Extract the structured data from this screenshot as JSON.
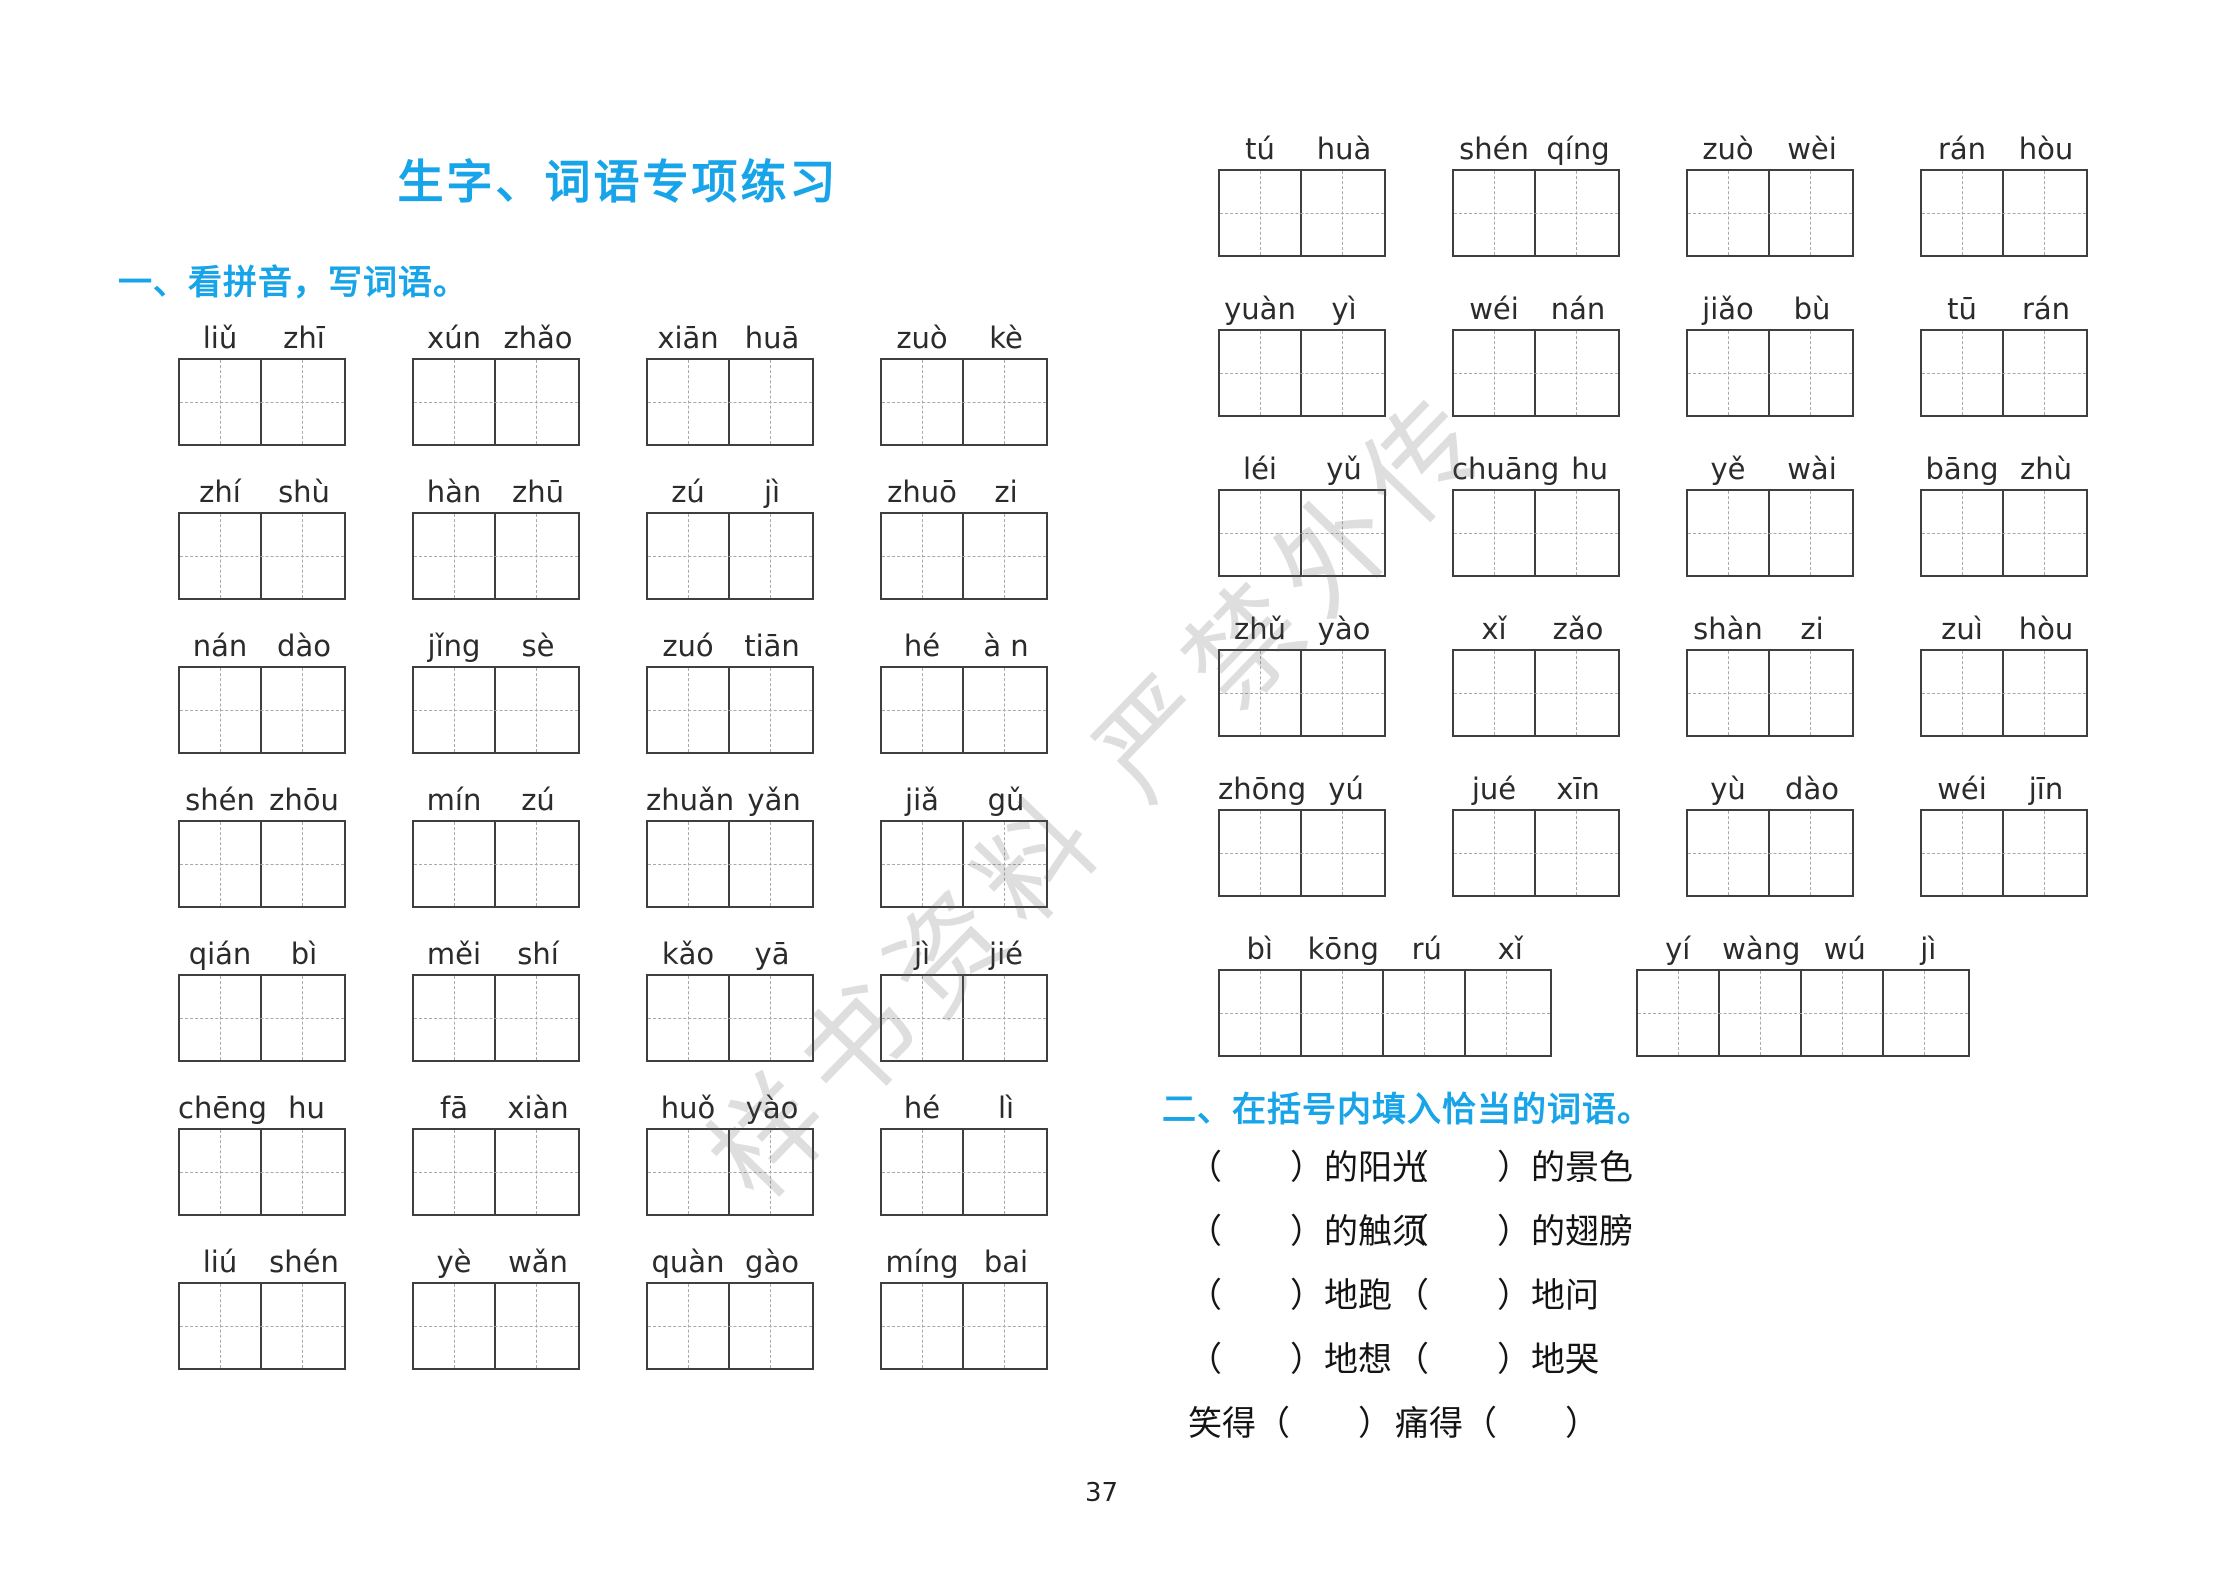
{
  "page": {
    "title": "生字、词语专项练习",
    "page_number": "37",
    "accent_color": "#18a4e8",
    "watermark": "样书资料 严禁外传"
  },
  "section_one": {
    "heading": "一、看拼音，写词语。",
    "left_groups": [
      {
        "syllables": [
          "liǔ",
          "zhī"
        ]
      },
      {
        "syllables": [
          "xún",
          "zhǎo"
        ]
      },
      {
        "syllables": [
          "xiān",
          "huā"
        ]
      },
      {
        "syllables": [
          "zuò",
          "kè"
        ]
      },
      {
        "syllables": [
          "zhí",
          "shù"
        ]
      },
      {
        "syllables": [
          "hàn",
          "zhū"
        ]
      },
      {
        "syllables": [
          "zú",
          "jì"
        ]
      },
      {
        "syllables": [
          "zhuō",
          "zi"
        ]
      },
      {
        "syllables": [
          "nán",
          "dào"
        ]
      },
      {
        "syllables": [
          "jǐng",
          "sè"
        ]
      },
      {
        "syllables": [
          "zuó",
          "tiān"
        ]
      },
      {
        "syllables": [
          "hé",
          "à n"
        ]
      },
      {
        "syllables": [
          "shén",
          "zhōu"
        ]
      },
      {
        "syllables": [
          "mín",
          "zú"
        ]
      },
      {
        "syllables": [
          "zhuǎn",
          "yǎn"
        ]
      },
      {
        "syllables": [
          "jiǎ",
          "gǔ"
        ]
      },
      {
        "syllables": [
          "qián",
          "bì"
        ]
      },
      {
        "syllables": [
          "měi",
          "shí"
        ]
      },
      {
        "syllables": [
          "kǎo",
          "yā"
        ]
      },
      {
        "syllables": [
          "jì",
          "jié"
        ]
      },
      {
        "syllables": [
          "chēng",
          "hu"
        ]
      },
      {
        "syllables": [
          "fā",
          "xiàn"
        ]
      },
      {
        "syllables": [
          "huǒ",
          "yào"
        ]
      },
      {
        "syllables": [
          "hé",
          "lì"
        ]
      },
      {
        "syllables": [
          "liú",
          "shén"
        ]
      },
      {
        "syllables": [
          "yè",
          "wǎn"
        ]
      },
      {
        "syllables": [
          "quàn",
          "gào"
        ]
      },
      {
        "syllables": [
          "míng",
          "bai"
        ]
      }
    ],
    "right_groups": [
      {
        "syllables": [
          "tú",
          "huà"
        ]
      },
      {
        "syllables": [
          "shén",
          "qíng"
        ]
      },
      {
        "syllables": [
          "zuò",
          "wèi"
        ]
      },
      {
        "syllables": [
          "rán",
          "hòu"
        ]
      },
      {
        "syllables": [
          "yuàn",
          "yì"
        ]
      },
      {
        "syllables": [
          "wéi",
          "nán"
        ]
      },
      {
        "syllables": [
          "jiǎo",
          "bù"
        ]
      },
      {
        "syllables": [
          "tū",
          "rán"
        ]
      },
      {
        "syllables": [
          "léi",
          "yǔ"
        ]
      },
      {
        "syllables": [
          "chuāng",
          "hu"
        ]
      },
      {
        "syllables": [
          "yě",
          "wài"
        ]
      },
      {
        "syllables": [
          "bāng",
          "zhù"
        ]
      },
      {
        "syllables": [
          "zhǔ",
          "yào"
        ]
      },
      {
        "syllables": [
          "xǐ",
          "zǎo"
        ]
      },
      {
        "syllables": [
          "shàn",
          "zi"
        ]
      },
      {
        "syllables": [
          "zuì",
          "hòu"
        ]
      },
      {
        "syllables": [
          "zhōng",
          "yú"
        ]
      },
      {
        "syllables": [
          "jué",
          "xīn"
        ]
      },
      {
        "syllables": [
          "yù",
          "dào"
        ]
      },
      {
        "syllables": [
          "wéi",
          "jīn"
        ]
      }
    ],
    "right_wide_groups": [
      {
        "syllables": [
          "bì",
          "kōng",
          "rú",
          "xǐ"
        ]
      },
      {
        "syllables": [
          "yí",
          "wàng",
          "wú",
          "jì"
        ]
      }
    ]
  },
  "section_two": {
    "heading": "二、在括号内填入恰当的词语。",
    "rows": [
      {
        "left": "（　　）的阳光",
        "right": "（　　）的景色"
      },
      {
        "left": "（　　）的触须",
        "right": "（　　）的翅膀"
      },
      {
        "left": "（　　）地跑",
        "right": "（　　）地问"
      },
      {
        "left": "（　　）地想",
        "right": "（　　）地哭"
      },
      {
        "left": "笑得（　　）",
        "right": "痛得（　　）"
      }
    ]
  }
}
